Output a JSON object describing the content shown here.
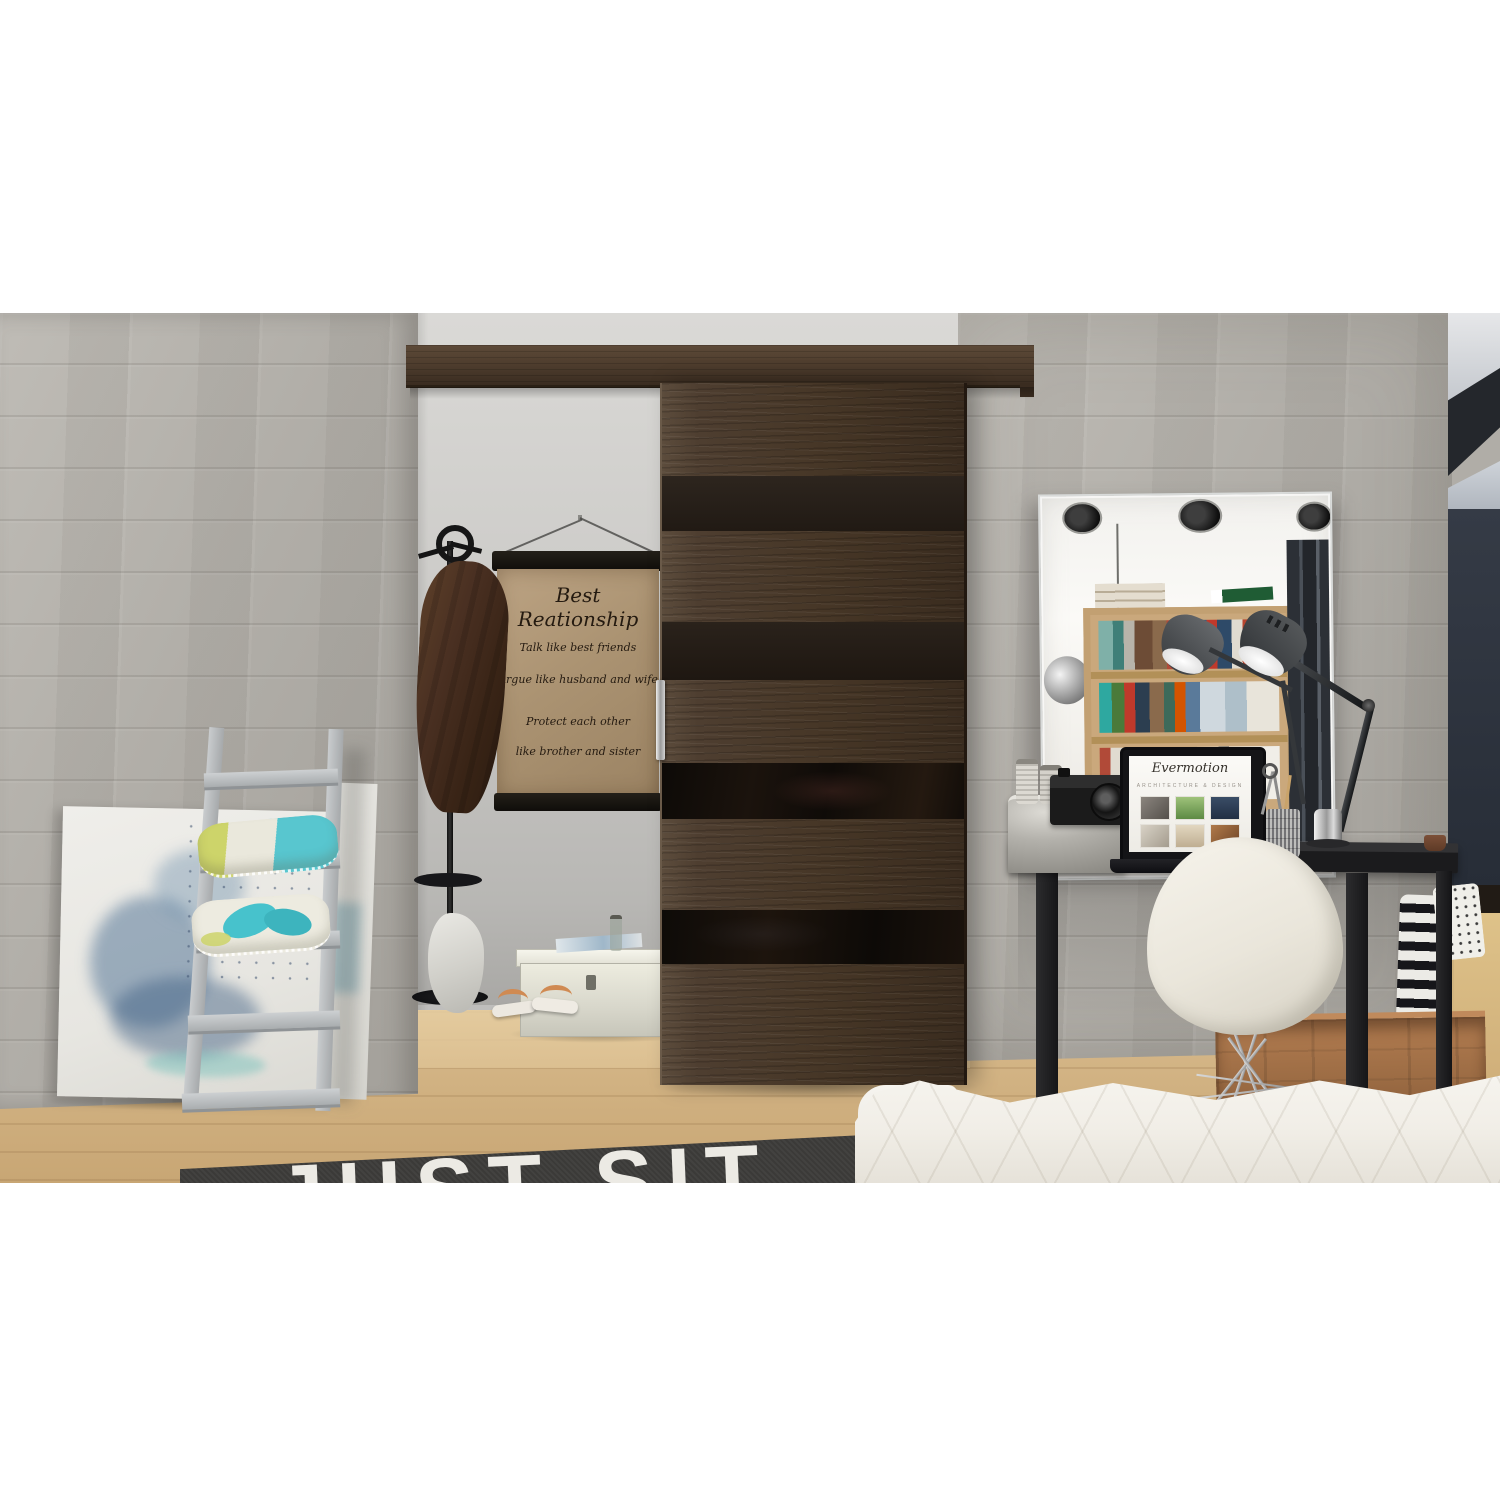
{
  "scene": {
    "poster": {
      "title": "Best Reationship",
      "line1": "Talk like best friends",
      "line2": "Argue like husband and wife",
      "line3": "Protect each other",
      "line4": "like brother and sister"
    },
    "rug": {
      "text": "JUST SIT"
    },
    "laptop_screen": {
      "logo": "Evermotion",
      "subtitle": "ARCHITECTURE & DESIGN"
    },
    "colors": {
      "concrete_wall": "#b0ada7",
      "hallway_wall": "#cbcac7",
      "door_wood": "#4e3e31",
      "door_glass_stripe": "#15100b",
      "rail_wood": "#4c3b2c",
      "floor_wood": "#d5b586",
      "rug": "#3a3937",
      "rug_text": "#eceae4",
      "pillow_teal": "#4fc4cf",
      "pillow_lime": "#cdd46a",
      "right_wall_navy": "#2c323c",
      "desk_black": "#202022",
      "crate_wood": "#a8764e",
      "mattress_white": "#f2efe9",
      "poster_paper": "#ac9574",
      "ladder_gray": "#b7babc"
    }
  }
}
